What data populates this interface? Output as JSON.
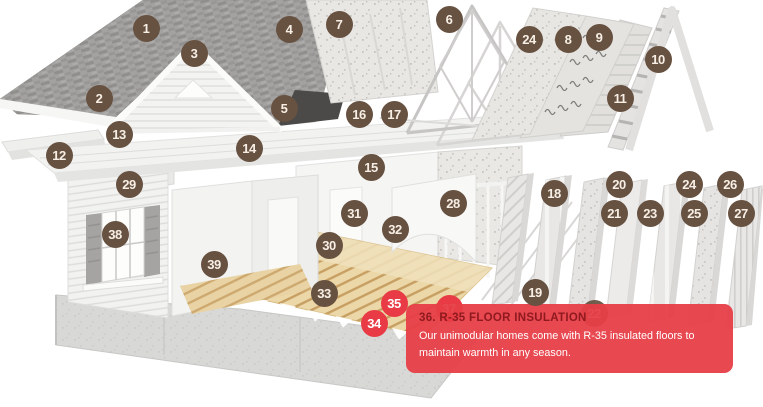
{
  "diagram_title": "modular-home-exploded-construction-diagram",
  "colors": {
    "marker": "#675141",
    "marker_text": "#f7efe5",
    "highlight": "#e83b45",
    "tooltip_bg": "rgba(231,62,71,0.95)",
    "tooltip_title": "#8e191e",
    "tooltip_text": "#ffffff"
  },
  "tooltip": {
    "title": "36. R-35 FLOOR INSULATION",
    "body": "Our unimodular homes come with R-35 insulated floors to\nmaintain warmth in any season.",
    "x": 406,
    "y": 304,
    "width": 327,
    "height": 69
  },
  "markers": [
    {
      "n": "1",
      "x": 146,
      "y": 28,
      "state": "default"
    },
    {
      "n": "2",
      "x": 99,
      "y": 98,
      "state": "default"
    },
    {
      "n": "3",
      "x": 194,
      "y": 53,
      "state": "default"
    },
    {
      "n": "4",
      "x": 289,
      "y": 29,
      "state": "default"
    },
    {
      "n": "5",
      "x": 284,
      "y": 108,
      "state": "default"
    },
    {
      "n": "6",
      "x": 449,
      "y": 19,
      "state": "default"
    },
    {
      "n": "7",
      "x": 339,
      "y": 24,
      "state": "default"
    },
    {
      "n": "8",
      "x": 568,
      "y": 39,
      "state": "default"
    },
    {
      "n": "9",
      "x": 599,
      "y": 37,
      "state": "default"
    },
    {
      "n": "10",
      "x": 658,
      "y": 59,
      "state": "default"
    },
    {
      "n": "11",
      "x": 620,
      "y": 98,
      "state": "default"
    },
    {
      "n": "12",
      "x": 59,
      "y": 155,
      "state": "default"
    },
    {
      "n": "13",
      "x": 119,
      "y": 134,
      "state": "default"
    },
    {
      "n": "14",
      "x": 249,
      "y": 148,
      "state": "default"
    },
    {
      "n": "15",
      "x": 371,
      "y": 167,
      "state": "default"
    },
    {
      "n": "16",
      "x": 359,
      "y": 114,
      "state": "default"
    },
    {
      "n": "17",
      "x": 394,
      "y": 114,
      "state": "default"
    },
    {
      "n": "18",
      "x": 554,
      "y": 193,
      "state": "default"
    },
    {
      "n": "19",
      "x": 535,
      "y": 292,
      "state": "default"
    },
    {
      "n": "20",
      "x": 619,
      "y": 184,
      "state": "default"
    },
    {
      "n": "21",
      "x": 614,
      "y": 213,
      "state": "default"
    },
    {
      "n": "22",
      "x": 594,
      "y": 313,
      "state": "behind"
    },
    {
      "n": "23",
      "x": 650,
      "y": 213,
      "state": "default"
    },
    {
      "n": "24",
      "x": 529,
      "y": 39,
      "state": "default"
    },
    {
      "n": "24",
      "x": 689,
      "y": 184,
      "state": "default"
    },
    {
      "n": "25",
      "x": 694,
      "y": 213,
      "state": "default"
    },
    {
      "n": "26",
      "x": 730,
      "y": 184,
      "state": "default"
    },
    {
      "n": "27",
      "x": 741,
      "y": 213,
      "state": "default"
    },
    {
      "n": "28",
      "x": 453,
      "y": 203,
      "state": "default"
    },
    {
      "n": "29",
      "x": 129,
      "y": 184,
      "state": "default"
    },
    {
      "n": "30",
      "x": 329,
      "y": 245,
      "state": "default"
    },
    {
      "n": "31",
      "x": 354,
      "y": 213,
      "state": "default"
    },
    {
      "n": "32",
      "x": 395,
      "y": 229,
      "state": "default"
    },
    {
      "n": "33",
      "x": 324,
      "y": 293,
      "state": "default"
    },
    {
      "n": "34",
      "x": 374,
      "y": 323,
      "state": "highlight"
    },
    {
      "n": "35",
      "x": 394,
      "y": 303,
      "state": "highlight"
    },
    {
      "n": "37",
      "x": 449,
      "y": 308,
      "state": "highlight-behind"
    },
    {
      "n": "38",
      "x": 115,
      "y": 234,
      "state": "default"
    },
    {
      "n": "39",
      "x": 214,
      "y": 264,
      "state": "default"
    }
  ]
}
